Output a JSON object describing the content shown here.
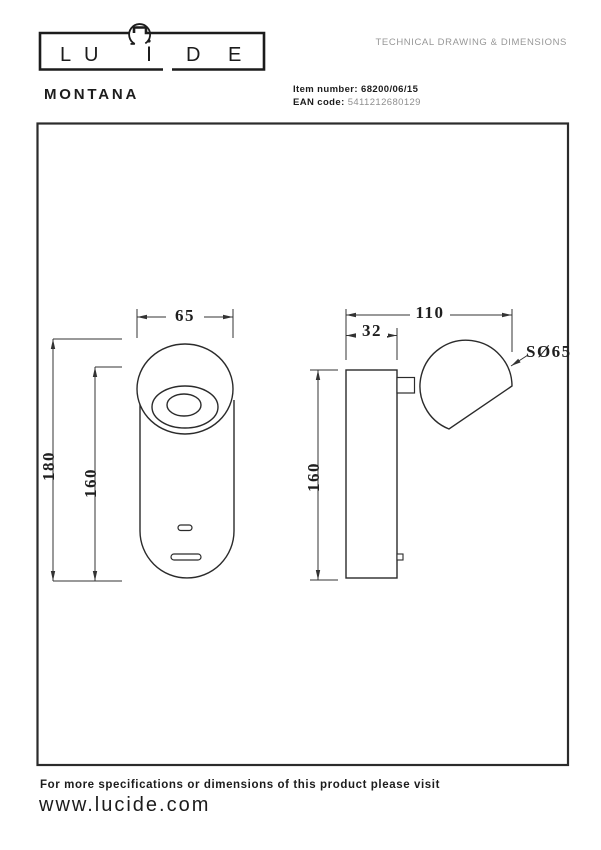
{
  "colors": {
    "ink": "#1c1c1c",
    "line": "#2b2b2b",
    "muted": "#979797"
  },
  "brand": {
    "name": "LUCIDE",
    "letters": {
      "l": "L",
      "u": "U",
      "c": "C",
      "i": "i",
      "d": "D",
      "e": "E"
    }
  },
  "header": {
    "doc_type": "TECHNICAL DRAWING & DIMENSIONS",
    "product_name": "MONTANA",
    "item_number_label": "Item number:",
    "item_number": "68200/06/15",
    "ean_label": "EAN code:",
    "ean_code": "5411212680129"
  },
  "drawing": {
    "front_view": {
      "head_diameter": "65",
      "overall_height": "180",
      "body_height": "160"
    },
    "side_view": {
      "overall_depth": "110",
      "base_depth": "32",
      "body_height": "160",
      "sphere_diameter": "SØ65"
    }
  },
  "footer": {
    "note": "For more specifications or dimensions of this product please visit",
    "website": "www.lucide.com"
  }
}
